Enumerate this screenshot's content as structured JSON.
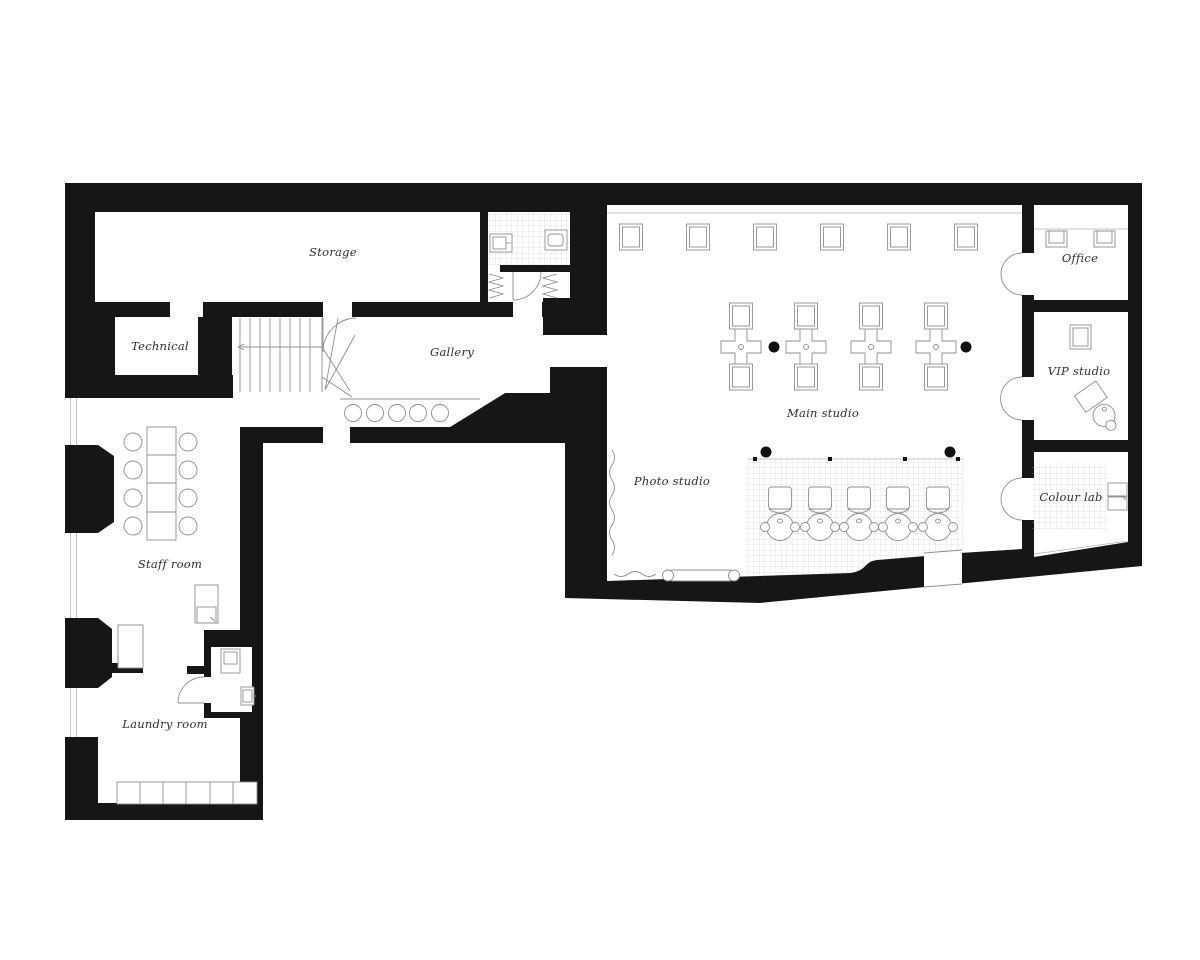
{
  "colors": {
    "wall": "#161616",
    "furniture_line": "#8f8f8f",
    "tile_grid": "#cccccc",
    "label_text": "#2e2e2e",
    "background": "#ffffff"
  },
  "rooms": {
    "storage": {
      "label": "Storage"
    },
    "technical": {
      "label": "Technical"
    },
    "gallery": {
      "label": "Gallery"
    },
    "staff_room": {
      "label": "Staff room"
    },
    "laundry_room": {
      "label": "Laundry room"
    },
    "photo_studio": {
      "label": "Photo studio"
    },
    "main_studio": {
      "label": "Main studio"
    },
    "office": {
      "label": "Office"
    },
    "vip_studio": {
      "label": "VIP studio"
    },
    "colour_lab": {
      "label": "Colour lab"
    }
  },
  "furniture_counts": {
    "main_studio_wall_stations": 6,
    "main_studio_styling_islands": 4,
    "backwash_units": 5,
    "gallery_stools": 5,
    "staff_room_chairs": 8,
    "laundry_machines": 6,
    "structural_columns": 4
  }
}
